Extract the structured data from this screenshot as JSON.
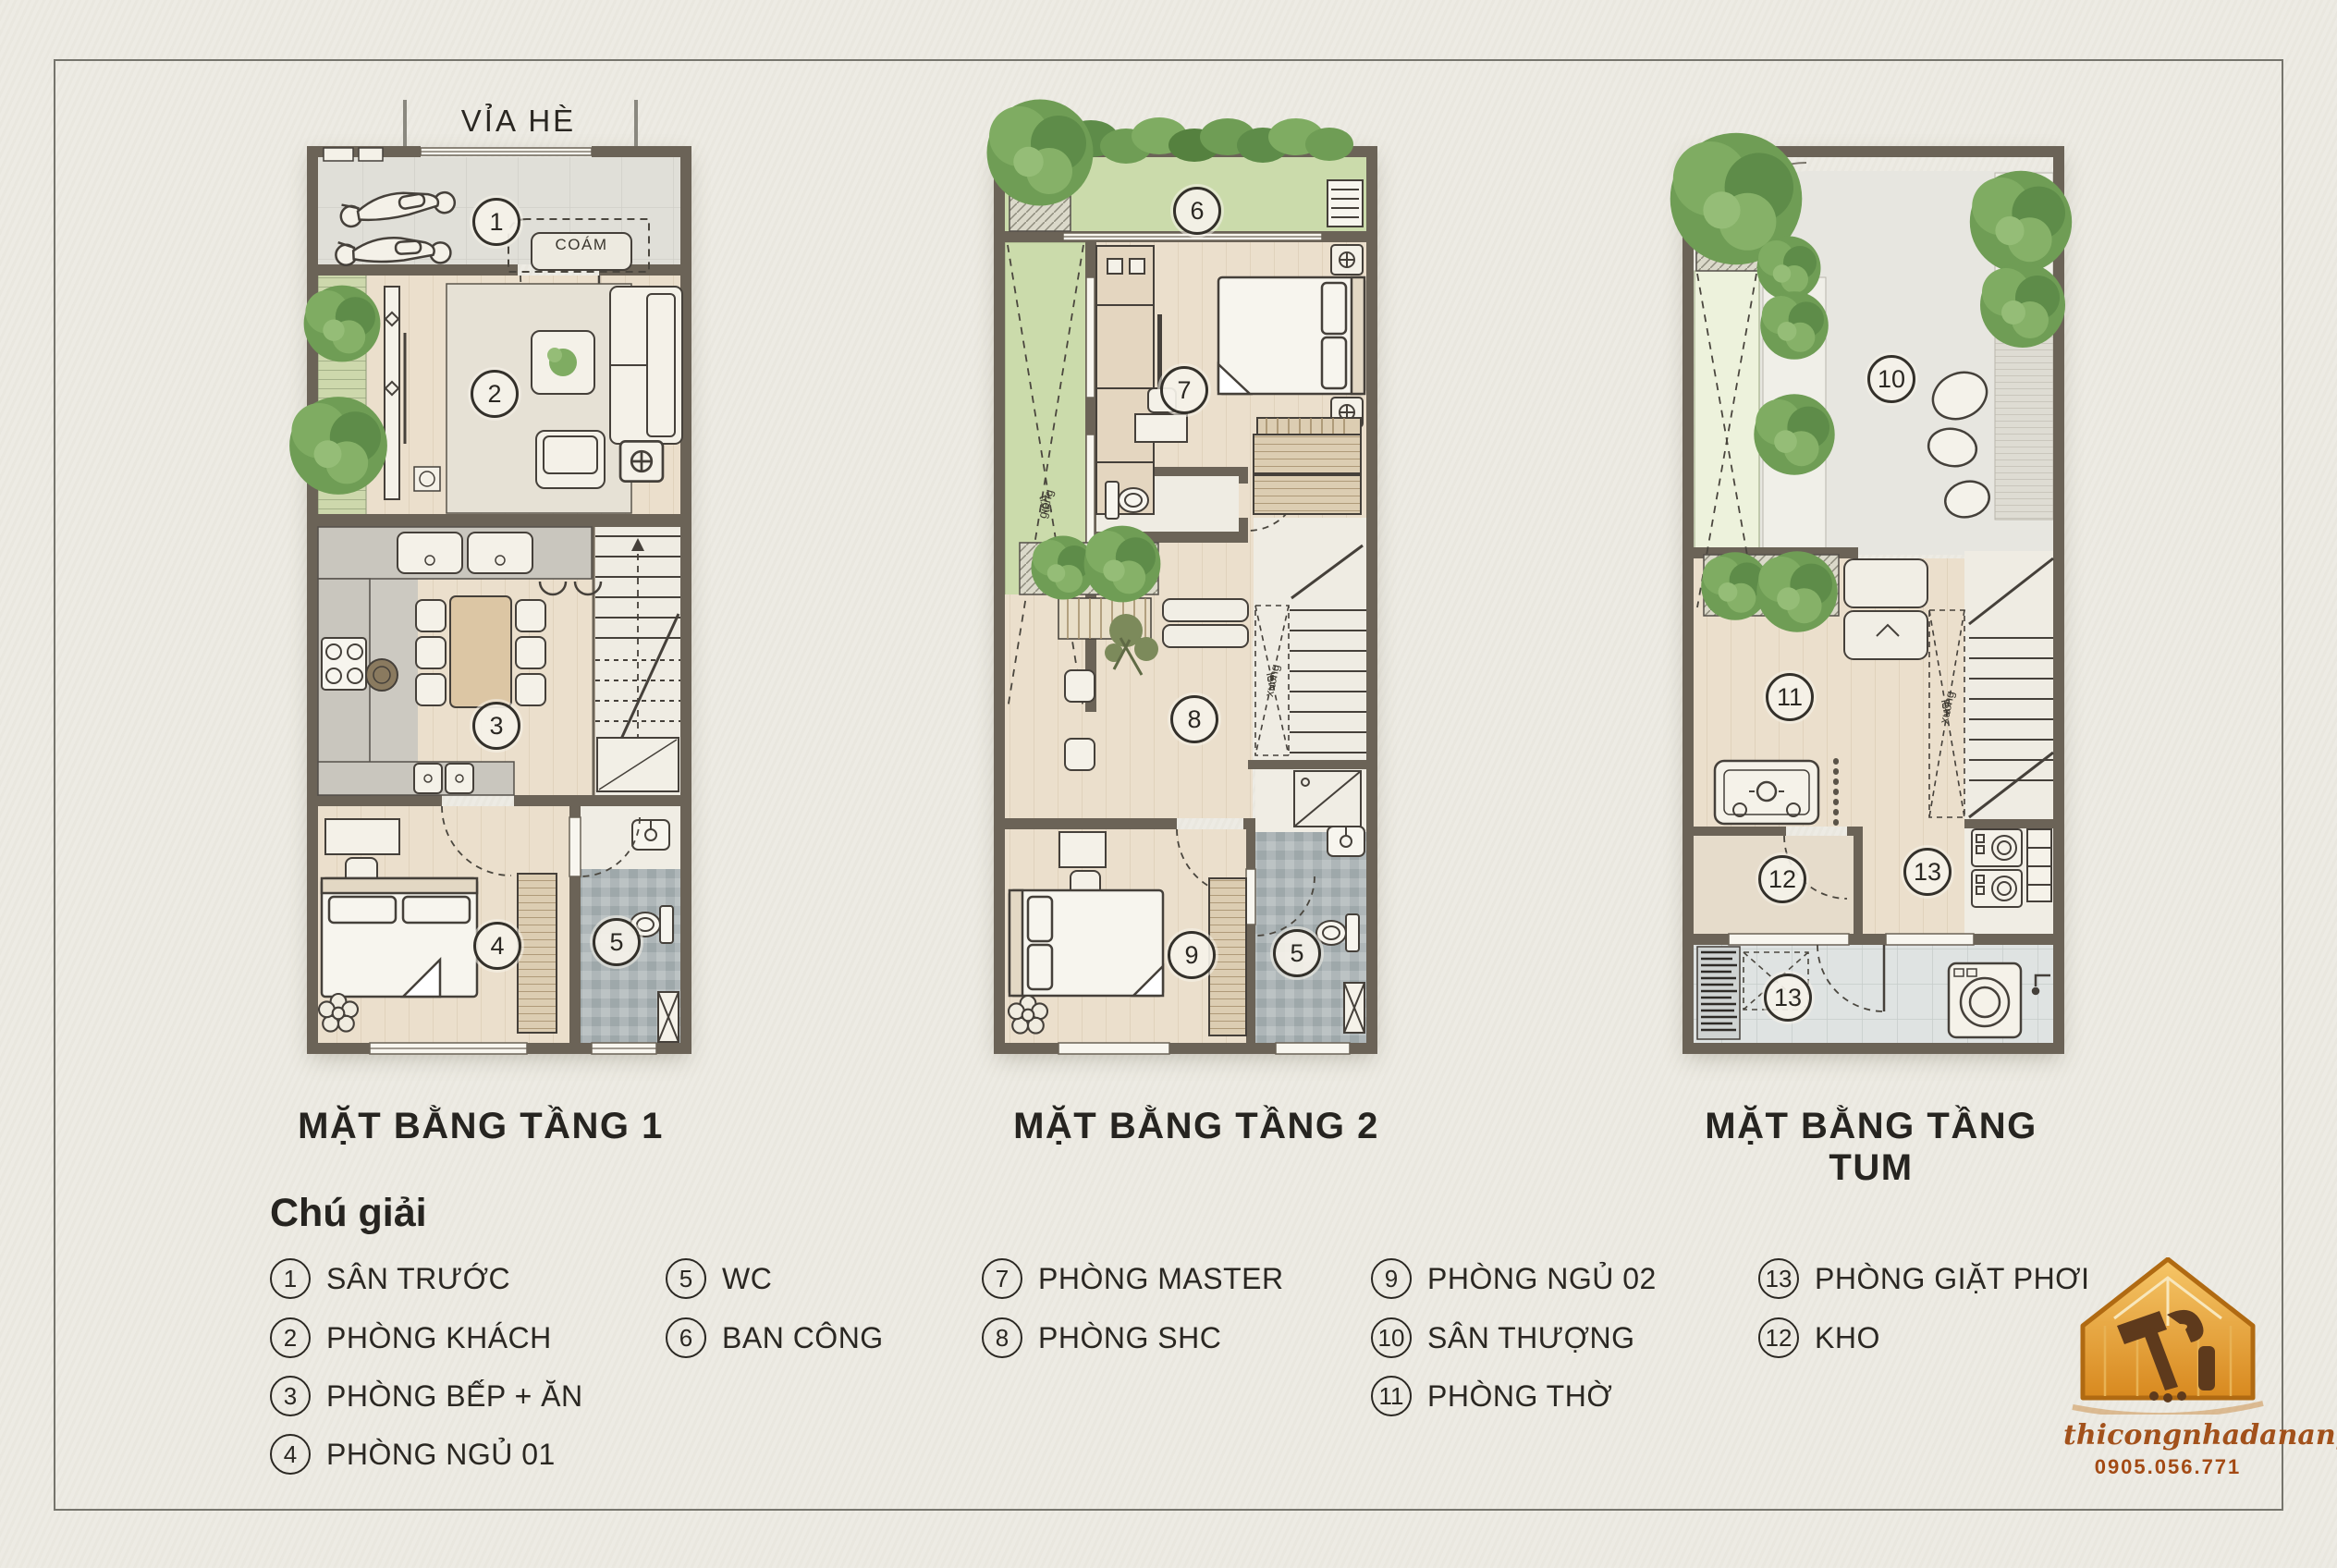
{
  "page": {
    "background": "#EDEBE3",
    "frame_color": "#75746C"
  },
  "plans": [
    {
      "name": "floor-1",
      "title": "MẶT BẰNG TẦNG 1",
      "street_label": "VỈA HÈ",
      "bench_label": "COÁM",
      "markers": [
        "1",
        "2",
        "3",
        "4",
        "5"
      ]
    },
    {
      "name": "floor-2",
      "title": "MẶT BẰNG TẦNG 2",
      "skylight_word_1": "giếng",
      "skylight_word_2": "trời",
      "stair_word_up": "lên",
      "stair_word_down": "xuống",
      "markers": [
        "6",
        "7",
        "8",
        "9",
        "5"
      ]
    },
    {
      "name": "floor-tum",
      "title": "MẶT BẰNG TẦNG TUM",
      "stair_word_up": "lên",
      "stair_word_down": "xuống",
      "markers": [
        "10",
        "11",
        "12",
        "13",
        "13"
      ]
    }
  ],
  "legend": {
    "heading": "Chú giải",
    "columns": [
      {
        "items": [
          {
            "n": "1",
            "label": "SÂN TRƯỚC"
          },
          {
            "n": "2",
            "label": "PHÒNG KHÁCH"
          },
          {
            "n": "3",
            "label": "PHÒNG BẾP + ĂN"
          },
          {
            "n": "4",
            "label": "PHÒNG NGỦ 01"
          }
        ]
      },
      {
        "items": [
          {
            "n": "5",
            "label": "WC"
          },
          {
            "n": "6",
            "label": "BAN CÔNG"
          }
        ]
      },
      {
        "items": [
          {
            "n": "7",
            "label": "PHÒNG MASTER"
          },
          {
            "n": "8",
            "label": "PHÒNG SHC"
          }
        ]
      },
      {
        "items": [
          {
            "n": "9",
            "label": "PHÒNG NGỦ 02"
          },
          {
            "n": "10",
            "label": "SÂN THƯỢNG"
          },
          {
            "n": "11",
            "label": "PHÒNG THỜ"
          }
        ]
      },
      {
        "items": [
          {
            "n": "13",
            "label": "PHÒNG GIẶT PHƠI"
          },
          {
            "n": "12",
            "label": "KHO"
          }
        ]
      }
    ]
  },
  "logo": {
    "website": "thicongnhadanang.com",
    "phone": "0905.056.771"
  },
  "colors": {
    "wall": "#6B6357",
    "greenery": "#6F9D55",
    "plan_green": "#CBDBAB",
    "gold": "#D88A1F",
    "text": "#2A2722"
  }
}
